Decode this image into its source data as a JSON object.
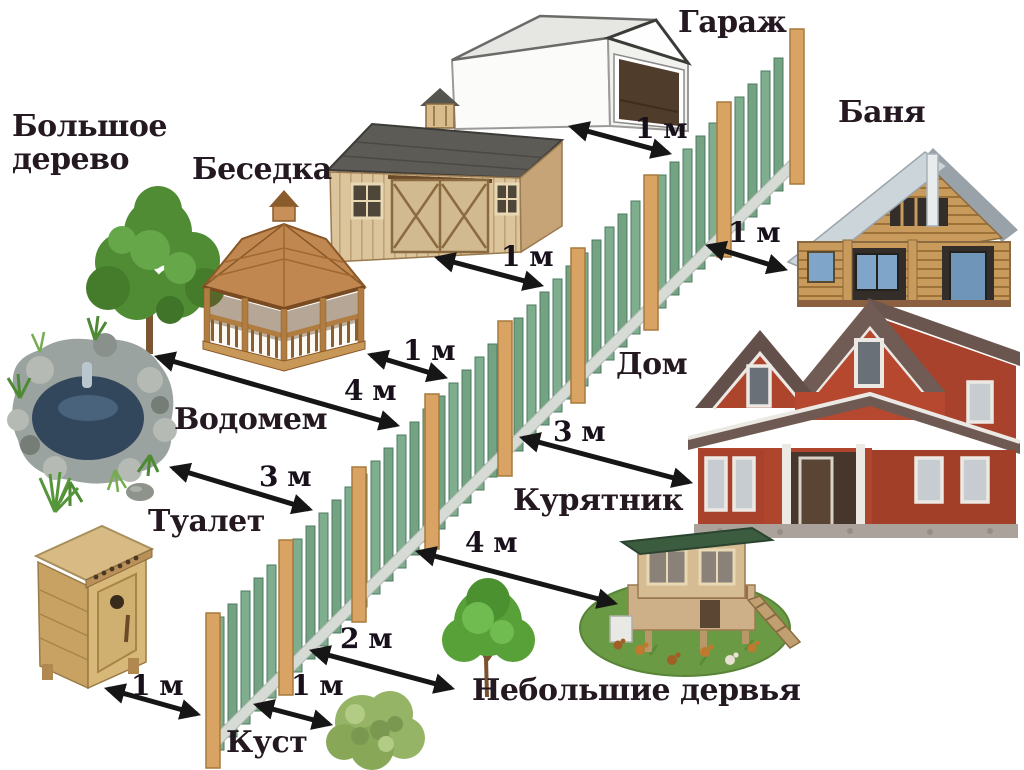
{
  "palette": {
    "background": "#ffffff",
    "text": "#241821",
    "arrow": "#161616",
    "fence_picket": "#7fae8e",
    "fence_picket_alt": "#73a382",
    "fence_picket_edge": "#4e7a60",
    "fence_post": "#d9a463",
    "fence_post_edge": "#a87a3c",
    "fence_rail": "#d6dbd5"
  },
  "labels": {
    "big_tree": "Большое дерево",
    "gazebo": "Беседка",
    "garage": "Гараж",
    "banya": "Баня",
    "pond": "Водомем",
    "house": "Дом",
    "toilet": "Туалет",
    "coop": "Курятник",
    "bush": "Куст",
    "small_trees": "Небольшие дервья"
  },
  "distances": {
    "garage_to_fence": "1 м",
    "shed_to_fence": "1 м",
    "banya_to_fence": "1 м",
    "gazebo_to_fence": "1 м",
    "big_tree_to_fence": "4 м",
    "pond_to_fence": "3 м",
    "house_to_fence": "3 м",
    "coop_to_fence": "4 м",
    "small_trees_to_fence": "2 м",
    "toilet_to_fence": "1 м",
    "bush_to_fence": "1 м"
  }
}
